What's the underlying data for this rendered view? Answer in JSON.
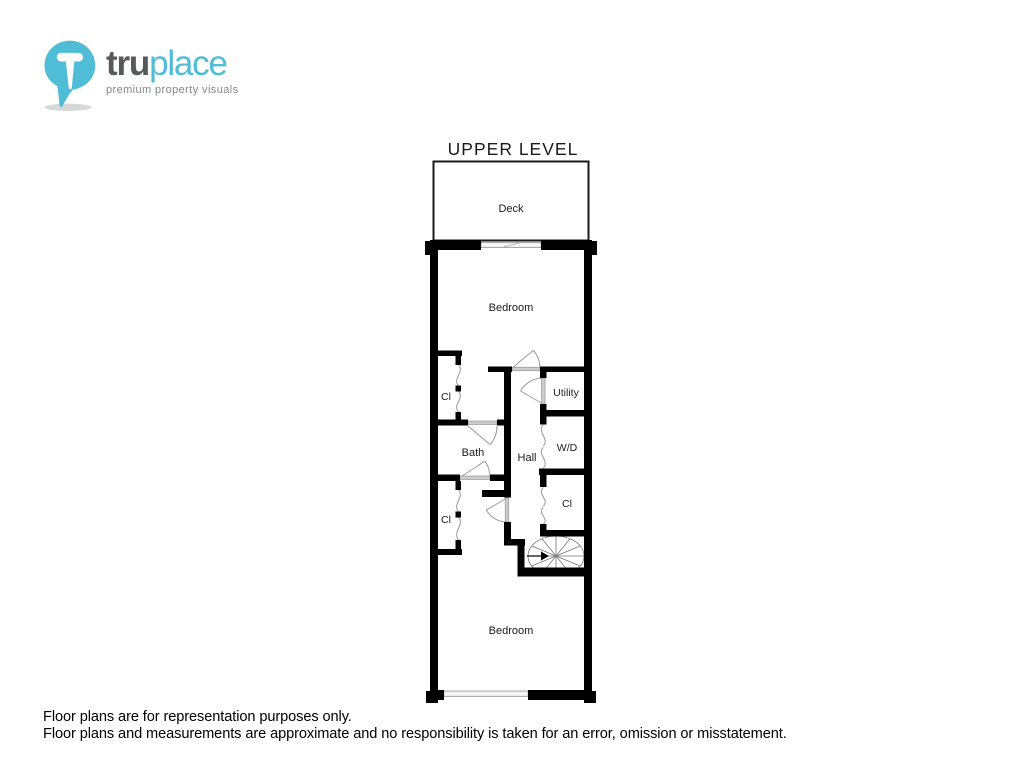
{
  "logo": {
    "icon_letter": "T",
    "brand_primary": "tru",
    "brand_secondary": "place",
    "tagline": "premium property visuals"
  },
  "plan": {
    "title": "UPPER LEVEL",
    "rooms": {
      "deck": "Deck",
      "bedroom_top": "Bedroom",
      "closet_upper_left": "Cl",
      "utility": "Utility",
      "bath": "Bath",
      "hall": "Hall",
      "washer_dryer": "W/D",
      "closet_right": "Cl",
      "closet_lower_left": "Cl",
      "bedroom_bottom": "Bedroom"
    }
  },
  "footer": {
    "line1": "Floor plans are for representation purposes only.",
    "line2": "Floor plans and measurements are approximate and no responsibility is taken for an error, omission or misstatement."
  },
  "colors": {
    "wall": "#000000",
    "door_symbol": "#9a9a9a",
    "door_panel": "#cccccc",
    "logo_blue": "#4fbdd6",
    "logo_dark": "#58595b",
    "logo_tagline": "#85878a"
  }
}
